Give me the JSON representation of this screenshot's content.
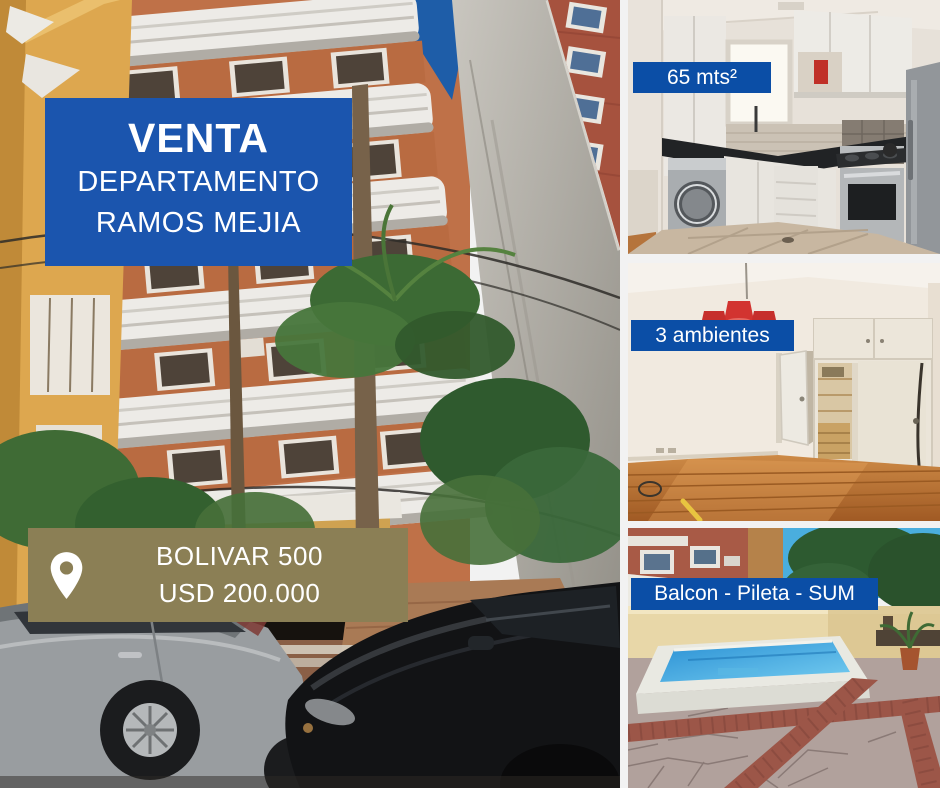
{
  "sale_banner": {
    "title": "VENTA",
    "line1": "DEPARTAMENTO",
    "line2": "RAMOS MEJIA"
  },
  "address_banner": {
    "icon": "location-pin-icon",
    "address": "BOLIVAR 500",
    "price": "USD 200.000"
  },
  "photo_tags": [
    {
      "label": "65 mts²"
    },
    {
      "label": "3 ambientes"
    },
    {
      "label": "Balcon - Pileta - SUM"
    }
  ],
  "colors": {
    "banner_blue": "#1b55ae",
    "tag_blue": "#0b4ea6",
    "address_olive": "#8b7f55",
    "background": "#f2f2f2",
    "text_white": "#ffffff"
  }
}
